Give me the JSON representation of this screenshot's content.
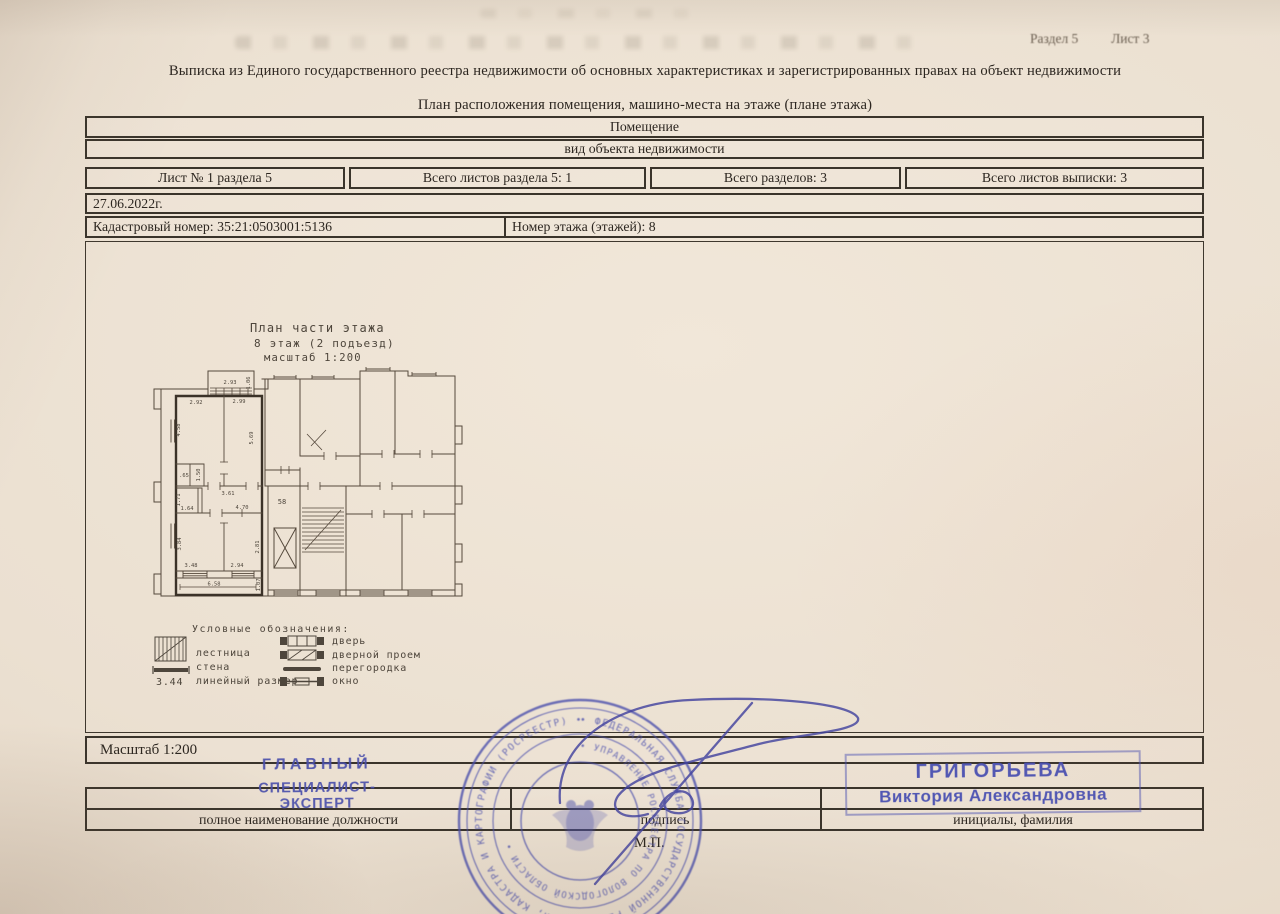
{
  "document": {
    "section_ref": "Раздел 5",
    "sheet_ref": "Лист 3",
    "title": "Выписка из Единого государственного реестра недвижимости об основных характеристиках и зарегистрированных правах на объект недвижимости",
    "subtitle": "План расположения помещения, машино-места на этаже (плане этажа)"
  },
  "info_table": {
    "object_kind": "Помещение",
    "object_kind_label": "вид объекта недвижимости",
    "sheet_cells": [
      "Лист № 1 раздела 5",
      "Всего листов раздела 5: 1",
      "Всего разделов: 3",
      "Всего листов выписки: 3"
    ],
    "date": "27.06.2022г.",
    "cadastral": "Кадастровый номер: 35:21:0503001:5136",
    "floor": "Номер этажа (этажей): 8"
  },
  "plan": {
    "heading_line1": "План части этажа",
    "heading_line2": "8 этаж (2 подъезд)",
    "heading_line3": "масштаб 1:200",
    "apartment_number": "58",
    "dims": {
      "balcony_w": "2.93",
      "balcony_d": "1.06",
      "room1_w": "2.92",
      "room2_w": "2.99",
      "room1_h": "4.58",
      "room2_h": "5.69",
      "closet_w": ".65",
      "closet_d": "1.50",
      "hall_w": "3.61",
      "wc_h": "1.71",
      "wc_w": "1.64",
      "hall2_w": "4.70",
      "room3_h": "3.84",
      "room4_h": "2.81",
      "room3_w": "3.48",
      "room4_w": "2.94",
      "bottom_w": "6.58",
      "bottom_d": "1.07"
    }
  },
  "legend": {
    "title": "Условные обозначения:",
    "item_stairs": "лестница",
    "item_wall": "стена",
    "item_lin": "линейный размер",
    "sample_dim": "3.44",
    "item_door": "дверь",
    "item_doorway": "дверной проем",
    "item_partition": "перегородка",
    "item_window": "окно"
  },
  "footer": {
    "scale": "Масштаб 1:200",
    "label_position": "полное наименование должности",
    "label_signature": "подпись",
    "label_name": "инициалы, фамилия",
    "mp": "М.П."
  },
  "stamps": {
    "position_line1": "ГЛАВНЫЙ",
    "position_line2": "СПЕЦИАЛИСТ-ЭКСПЕРТ",
    "name_line1": "ГРИГОРЬЕВА",
    "name_line2": "Виктория Александровна",
    "round_outer": "• ФЕДЕРАЛЬНАЯ СЛУЖБА ГОСУДАРСТВЕННОЙ РЕГИСТРАЦИИ, КАДАСТРА И КАРТОГРАФИИ (РОСРЕЕСТР) •",
    "round_inner": "• УПРАВЛЕНИЕ РОСРЕЕСТРА ПО ВОЛОГОДСКОЙ ОБЛАСТИ •"
  },
  "colors": {
    "paper": "#eadfd0",
    "ink": "#2c2620",
    "table_line": "#3a342b",
    "stamp_blue": "#4a50ae",
    "plan_line": "#55493c"
  }
}
